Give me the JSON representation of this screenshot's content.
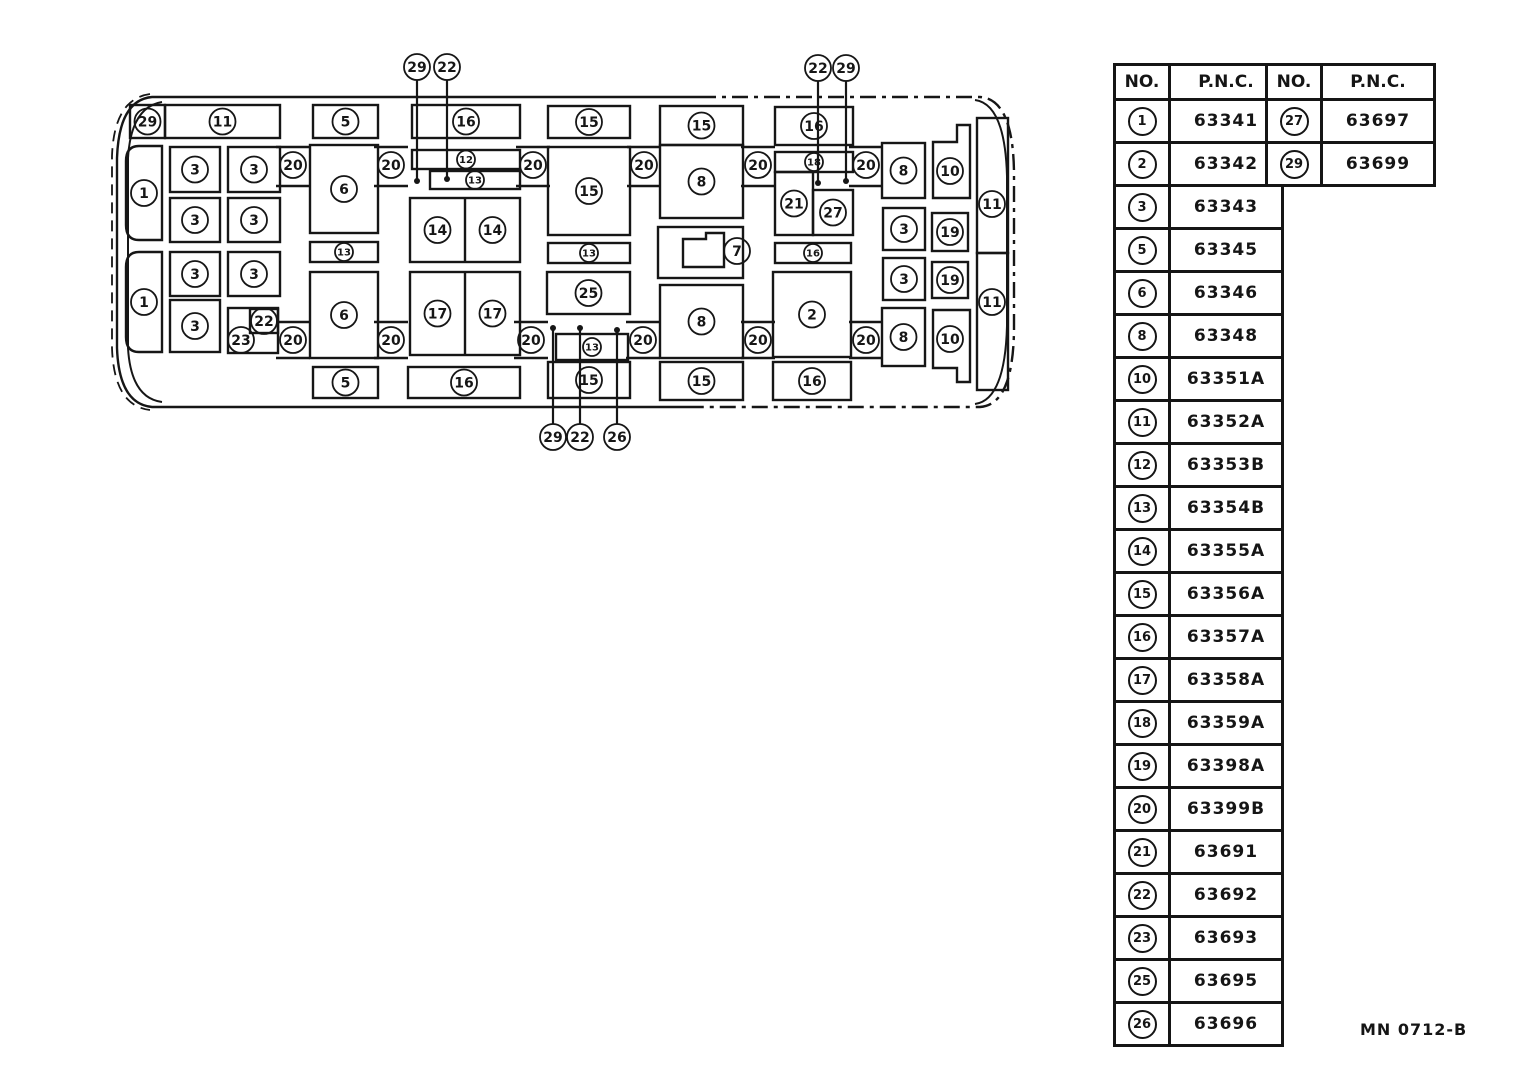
{
  "footer": {
    "code": "MN 0712-B"
  },
  "tables": {
    "left": {
      "headers": [
        "NO.",
        "P.N.C."
      ],
      "rows": [
        [
          "1",
          "63341"
        ],
        [
          "2",
          "63342"
        ],
        [
          "3",
          "63343"
        ],
        [
          "5",
          "63345"
        ],
        [
          "6",
          "63346"
        ],
        [
          "8",
          "63348"
        ],
        [
          "10",
          "63351A"
        ],
        [
          "11",
          "63352A"
        ],
        [
          "12",
          "63353B"
        ],
        [
          "13",
          "63354B"
        ],
        [
          "14",
          "63355A"
        ],
        [
          "15",
          "63356A"
        ],
        [
          "16",
          "63357A"
        ],
        [
          "17",
          "63358A"
        ],
        [
          "18",
          "63359A"
        ],
        [
          "19",
          "63398A"
        ],
        [
          "20",
          "63399B"
        ],
        [
          "21",
          "63691"
        ],
        [
          "22",
          "63692"
        ],
        [
          "23",
          "63693"
        ],
        [
          "25",
          "63695"
        ],
        [
          "26",
          "63696"
        ]
      ]
    },
    "right": {
      "headers": [
        "NO.",
        "P.N.C."
      ],
      "rows": [
        [
          "27",
          "63697"
        ],
        [
          "29",
          "63699"
        ]
      ]
    }
  },
  "diagram": {
    "ink": "#161616",
    "boxes": [
      {
        "x": 130,
        "y": 105,
        "w": 35,
        "h": 33,
        "n": "29"
      },
      {
        "x": 165,
        "y": 105,
        "w": 115,
        "h": 33,
        "n": "11"
      },
      {
        "x": 313,
        "y": 105,
        "w": 65,
        "h": 33,
        "n": "5"
      },
      {
        "x": 412,
        "y": 105,
        "w": 108,
        "h": 33,
        "n": "16"
      },
      {
        "x": 548,
        "y": 106,
        "w": 82,
        "h": 32,
        "n": "15"
      },
      {
        "x": 660,
        "y": 106,
        "w": 83,
        "h": 39,
        "n": "15"
      },
      {
        "x": 775,
        "y": 107,
        "w": 78,
        "h": 38,
        "n": "16"
      },
      {
        "x": 126,
        "y": 146,
        "w": 36,
        "h": 94,
        "n": "1",
        "rl": 1
      },
      {
        "x": 126,
        "y": 252,
        "w": 36,
        "h": 100,
        "n": "1",
        "rl": 1
      },
      {
        "x": 170,
        "y": 147,
        "w": 50,
        "h": 45,
        "n": "3"
      },
      {
        "x": 228,
        "y": 147,
        "w": 52,
        "h": 45,
        "n": "3"
      },
      {
        "x": 170,
        "y": 198,
        "w": 50,
        "h": 44,
        "n": "3"
      },
      {
        "x": 228,
        "y": 198,
        "w": 52,
        "h": 44,
        "n": "3"
      },
      {
        "x": 170,
        "y": 252,
        "w": 50,
        "h": 44,
        "n": "3"
      },
      {
        "x": 228,
        "y": 252,
        "w": 52,
        "h": 44,
        "n": "3"
      },
      {
        "x": 170,
        "y": 300,
        "w": 50,
        "h": 52,
        "n": "3"
      },
      {
        "x": 228,
        "y": 308,
        "w": 50,
        "h": 45,
        "n": "23",
        "lx": 241,
        "ly": 340
      },
      {
        "x": 250,
        "y": 309,
        "w": 28,
        "h": 24,
        "n": "22",
        "lx": 264,
        "ly": 321
      },
      {
        "x": 310,
        "y": 145,
        "w": 68,
        "h": 88,
        "n": "6"
      },
      {
        "x": 310,
        "y": 242,
        "w": 68,
        "h": 20,
        "n": "13",
        "sm": 1
      },
      {
        "x": 310,
        "y": 272,
        "w": 68,
        "h": 86,
        "n": "6"
      },
      {
        "x": 313,
        "y": 367,
        "w": 65,
        "h": 31,
        "n": "5"
      },
      {
        "x": 412,
        "y": 150,
        "w": 108,
        "h": 19,
        "n": "12",
        "sm": 1
      },
      {
        "x": 430,
        "y": 171,
        "w": 90,
        "h": 18,
        "n": "13",
        "sm": 1
      },
      {
        "x": 408,
        "y": 367,
        "w": 112,
        "h": 31,
        "n": "16"
      },
      {
        "x": 548,
        "y": 147,
        "w": 82,
        "h": 88,
        "n": "15"
      },
      {
        "x": 548,
        "y": 243,
        "w": 82,
        "h": 20,
        "n": "13",
        "sm": 1
      },
      {
        "x": 547,
        "y": 272,
        "w": 83,
        "h": 42,
        "n": "25"
      },
      {
        "x": 556,
        "y": 334,
        "w": 72,
        "h": 26,
        "n": "13",
        "sm": 1
      },
      {
        "x": 548,
        "y": 362,
        "w": 82,
        "h": 36,
        "n": "15"
      },
      {
        "x": 660,
        "y": 145,
        "w": 83,
        "h": 73,
        "n": "8"
      },
      {
        "x": 658,
        "y": 227,
        "w": 85,
        "h": 51,
        "n": null
      },
      {
        "x": 660,
        "y": 285,
        "w": 83,
        "h": 73,
        "n": "8"
      },
      {
        "x": 660,
        "y": 362,
        "w": 83,
        "h": 38,
        "n": "15"
      },
      {
        "x": 775,
        "y": 152,
        "w": 78,
        "h": 20,
        "n": "18",
        "sm": 1
      },
      {
        "x": 775,
        "y": 172,
        "w": 38,
        "h": 63,
        "n": "21"
      },
      {
        "x": 813,
        "y": 190,
        "w": 40,
        "h": 45,
        "n": "27"
      },
      {
        "x": 775,
        "y": 243,
        "w": 76,
        "h": 20,
        "n": "16",
        "sm": 1
      },
      {
        "x": 773,
        "y": 272,
        "w": 78,
        "h": 85,
        "n": "2"
      },
      {
        "x": 773,
        "y": 362,
        "w": 78,
        "h": 38,
        "n": "16"
      },
      {
        "x": 882,
        "y": 143,
        "w": 43,
        "h": 55,
        "n": "8"
      },
      {
        "x": 883,
        "y": 208,
        "w": 42,
        "h": 42,
        "n": "3"
      },
      {
        "x": 883,
        "y": 258,
        "w": 42,
        "h": 42,
        "n": "3"
      },
      {
        "x": 882,
        "y": 308,
        "w": 43,
        "h": 58,
        "n": "8"
      },
      {
        "x": 932,
        "y": 213,
        "w": 36,
        "h": 38,
        "n": "19"
      },
      {
        "x": 932,
        "y": 262,
        "w": 36,
        "h": 36,
        "n": "19"
      },
      {
        "x": 977,
        "y": 118,
        "w": 31,
        "h": 135,
        "n": "11",
        "lx": 992,
        "ly": 204
      },
      {
        "x": 977,
        "y": 253,
        "w": 31,
        "h": 137,
        "n": "11",
        "lx": 992,
        "ly": 302
      }
    ],
    "splits": [
      {
        "x": 410,
        "y": 198,
        "w": 110,
        "h": 64,
        "n": "14"
      },
      {
        "x": 410,
        "y": 272,
        "w": 110,
        "h": 83,
        "n": "17"
      }
    ],
    "polys": [
      {
        "pts": "957,125 970,125 970,198 933,198 933,142 957,142",
        "n": "10",
        "lx": 950,
        "ly": 171
      },
      {
        "pts": "933,310 970,310 970,382 957,382 957,368 933,368",
        "n": "10",
        "lx": 950,
        "ly": 339
      },
      {
        "pts": "683,267 683,239 706,239 706,233 724,233 724,267",
        "n": null
      }
    ],
    "free_labels": [
      {
        "n": "7",
        "x": 737,
        "y": 251
      }
    ],
    "joints": {
      "label": "20",
      "top": {
        "y": 165,
        "rails": [
          147,
          186
        ],
        "xs": [
          293,
          391,
          533,
          644,
          758,
          866
        ]
      },
      "bottom": {
        "y": 340,
        "rails": [
          322,
          358
        ],
        "xs": [
          293,
          391,
          531,
          643,
          758,
          866
        ]
      }
    },
    "callouts": [
      {
        "n": "29",
        "x": 417,
        "y": 67,
        "ey": 181
      },
      {
        "n": "22",
        "x": 447,
        "y": 67,
        "ey": 179
      },
      {
        "n": "22",
        "x": 818,
        "y": 68,
        "ey": 183
      },
      {
        "n": "29",
        "x": 846,
        "y": 68,
        "ey": 181
      },
      {
        "n": "29",
        "x": 553,
        "y": 437,
        "ey": 328
      },
      {
        "n": "22",
        "x": 580,
        "y": 437,
        "ey": 328
      },
      {
        "n": "26",
        "x": 617,
        "y": 437,
        "ey": 330
      }
    ]
  }
}
